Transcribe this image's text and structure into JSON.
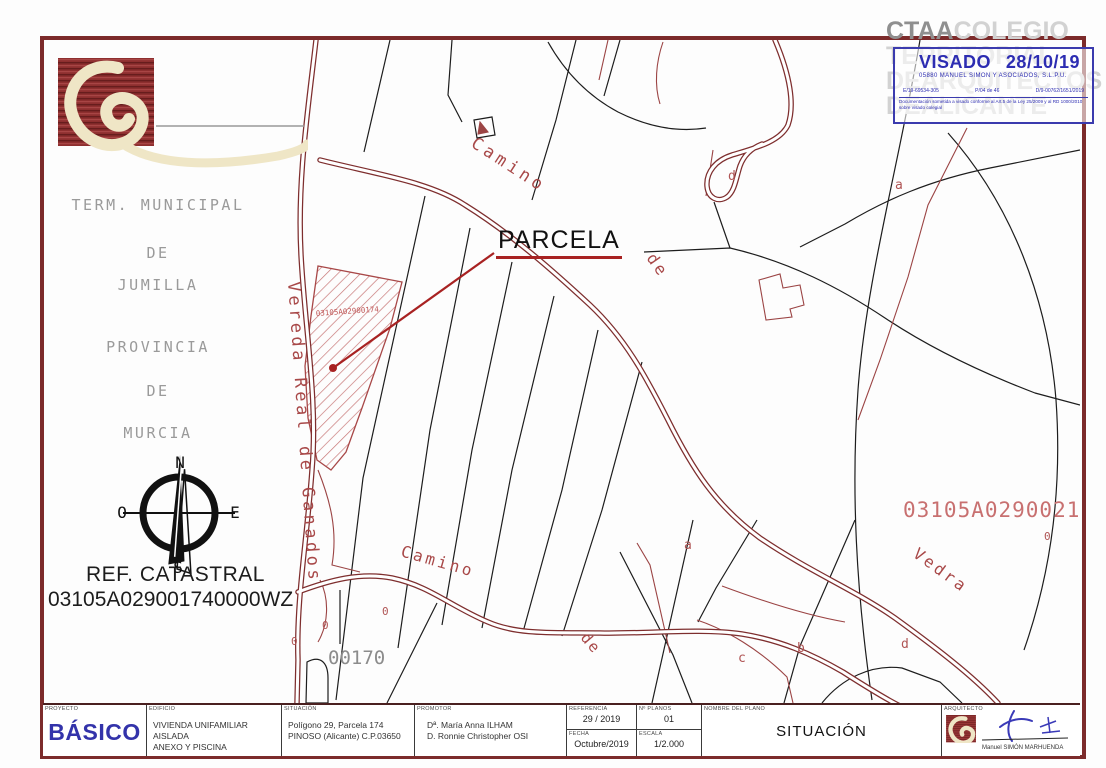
{
  "location_block": {
    "line1": "TERM. MUNICIPAL",
    "line2": "DE",
    "line3": "JUMILLA",
    "line4": "PROVINCIA",
    "line5": "DE",
    "line6": "MURCIA"
  },
  "compass": {
    "north": "N",
    "south": "S",
    "east": "E",
    "west": "O"
  },
  "ref_catastral": {
    "label": "REF. CATASTRAL",
    "value": "03105A029001740000WZ"
  },
  "map": {
    "parcela_label": "PARCELA",
    "parcel_code_small": "03105A02900174",
    "parcel_code_large": "03105A02900217",
    "parcel_number": "00170",
    "road_vereda": "Vereda Real de Ganados",
    "road_camino_upper": "Camino",
    "road_de_upper": "de",
    "road_camino_lower": "Camino",
    "road_de_lower": "de",
    "road_vedra": "Vedra",
    "letters": {
      "a1": "a",
      "a2": "a",
      "b": "b",
      "c": "c",
      "d1": "d",
      "d2": "d"
    },
    "zeros": [
      "0",
      "0",
      "0",
      "0"
    ]
  },
  "stamp": {
    "watermark_word1": "CTAA",
    "watermark_word2": "COLEGIO",
    "watermark_line2": "TERRITORIAL",
    "watermark_line3": "DEARQUITECTOS",
    "watermark_line4": "DEALICANTE",
    "visado_label": "VISADO",
    "visado_date": "28/10/19",
    "subtitle": "05880 MANUEL SIMON Y ASOCIADOS, S.L.P.U.",
    "code1": "E/19-69534-305",
    "code2": "P/04 de 46",
    "code3": "D/9-00762/1651/2019",
    "disclaimer": "Documentación sometida a visado conforme al Art.5 de la Ley 25/2009 y al RD 1000/2010 sobre visado colegial"
  },
  "titleblock": {
    "proyecto_header": "PROYECTO",
    "proyecto": "BÁSICO",
    "edificio_header": "EDIFICIO",
    "edificio_line1": "VIVIENDA UNIFAMILIAR  AISLADA",
    "edificio_line2": "ANEXO Y PISCINA",
    "situacion_header": "SITUACIÓN",
    "situacion_line1": "Polígono 29,  Parcela 174",
    "situacion_line2": "PINOSO (Alicante) C.P.03650",
    "promotor_header": "PROMOTOR",
    "promotor_line1": "Dª. María Anna ILHAM",
    "promotor_line2": "D. Ronnie Christopher OSI",
    "referencia_header": "REFERENCIA",
    "referencia": "29 / 2019",
    "num_planos_header": "Nº PLANOS",
    "num_planos": "01",
    "fecha_header": "FECHA",
    "fecha": "Octubre/2019",
    "escala_header": "ESCALA",
    "escala": "1/2.000",
    "nombre_plano_header": "NOMBRE DEL PLANO",
    "nombre_plano": "SITUACIÓN",
    "arquitecto_header": "ARQUITECTO",
    "arquitecto_nombre": "Manuel SIMÓN MARHUENDA"
  },
  "colors": {
    "border_red": "#7c2b2b",
    "road_red": "#7e2e2e",
    "stamp_blue": "#3b3bae",
    "hatch_red": "#c87878"
  }
}
